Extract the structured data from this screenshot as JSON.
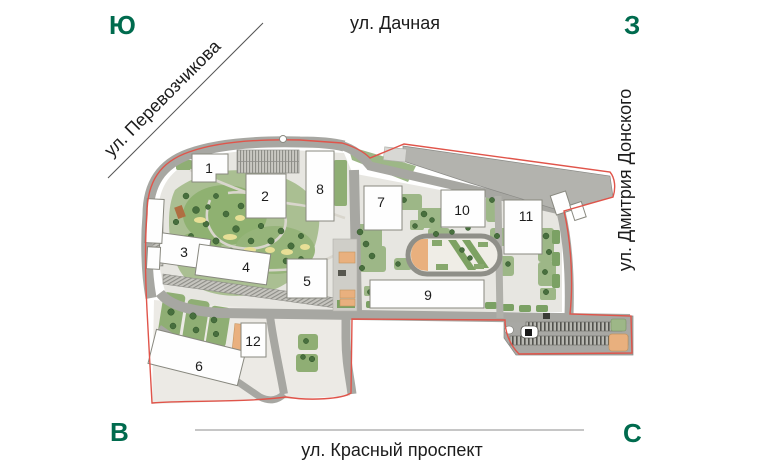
{
  "compass": {
    "top_left": "Ю",
    "top_right": "З",
    "bottom_left": "В",
    "bottom_right": "С"
  },
  "streets": {
    "top": "ул. Дачная",
    "left_diagonal": "ул. Перевозчикова",
    "right_vertical": "ул. Дмитрия Донского",
    "bottom": "ул. Красный проспект"
  },
  "buildings": [
    {
      "label": "1"
    },
    {
      "label": "2"
    },
    {
      "label": "3"
    },
    {
      "label": "4"
    },
    {
      "label": "5"
    },
    {
      "label": "6"
    },
    {
      "label": "7"
    },
    {
      "label": "8"
    },
    {
      "label": "9"
    },
    {
      "label": "10"
    },
    {
      "label": "11"
    },
    {
      "label": "12"
    }
  ],
  "colors": {
    "compass_green": "#006b4e",
    "boundary_red": "#e0544a",
    "road_gray": "#a7a7a2",
    "quarter_gray": "#e7e6e1",
    "green_area": "#8fae74",
    "orange_pad": "#e9b07e"
  }
}
